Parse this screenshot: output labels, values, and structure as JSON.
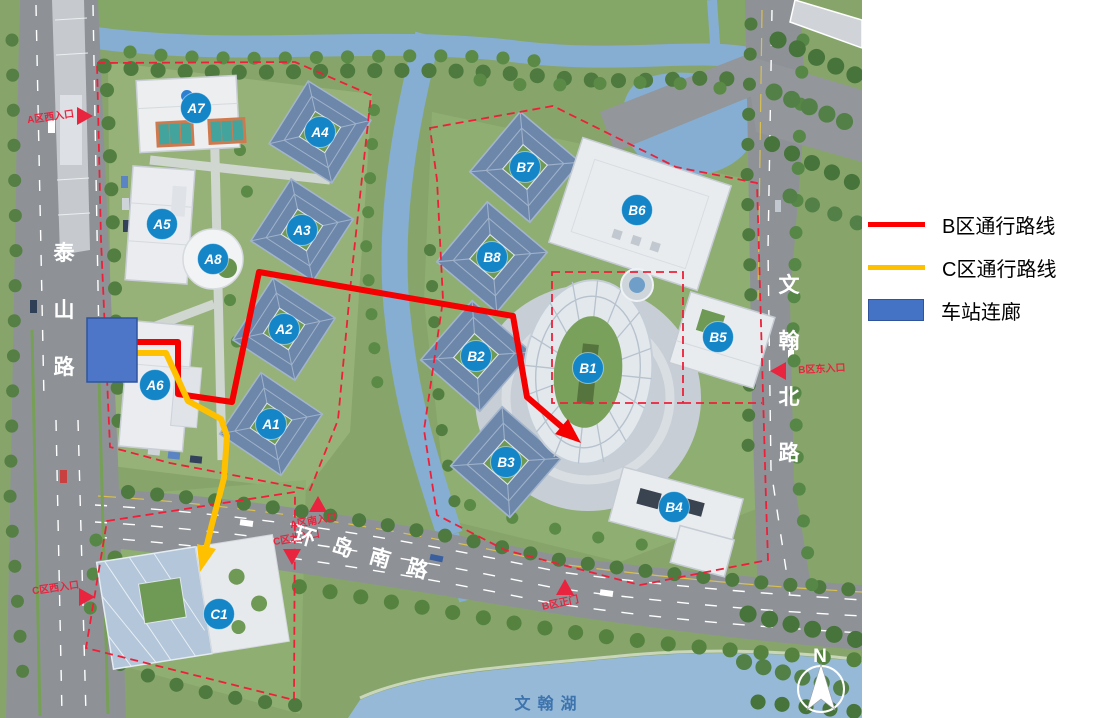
{
  "legend": {
    "items": [
      {
        "label": "B区通行路线",
        "color": "#FF0000",
        "type": "line"
      },
      {
        "label": "C区通行路线",
        "color": "#FFC000",
        "type": "line"
      },
      {
        "label": "车站连廊",
        "color": "#4472C4",
        "type": "rect"
      }
    ]
  },
  "map": {
    "buildings": [
      {
        "label": "A1",
        "x": 271,
        "y": 424
      },
      {
        "label": "A2",
        "x": 284,
        "y": 329
      },
      {
        "label": "A3",
        "x": 302,
        "y": 230
      },
      {
        "label": "A4",
        "x": 320,
        "y": 132
      },
      {
        "label": "A5",
        "x": 162,
        "y": 224
      },
      {
        "label": "A6",
        "x": 155,
        "y": 385
      },
      {
        "label": "A7",
        "x": 196,
        "y": 108
      },
      {
        "label": "A8",
        "x": 213,
        "y": 259
      },
      {
        "label": "B1",
        "x": 588,
        "y": 368
      },
      {
        "label": "B2",
        "x": 476,
        "y": 356
      },
      {
        "label": "B3",
        "x": 506,
        "y": 462
      },
      {
        "label": "B4",
        "x": 674,
        "y": 507
      },
      {
        "label": "B5",
        "x": 718,
        "y": 337
      },
      {
        "label": "B6",
        "x": 637,
        "y": 210
      },
      {
        "label": "B7",
        "x": 525,
        "y": 167
      },
      {
        "label": "B8",
        "x": 492,
        "y": 257
      },
      {
        "label": "C1",
        "x": 219,
        "y": 614
      }
    ],
    "entrances": [
      {
        "label": "A区西入口",
        "x": 51,
        "y": 120,
        "rot": -8,
        "dir": "right",
        "tx": 84,
        "ty": 116
      },
      {
        "label": "A区南入口",
        "x": 314,
        "y": 524,
        "rot": -10,
        "dir": "up",
        "tx": 318,
        "ty": 505
      },
      {
        "label": "C区北入口",
        "x": 297,
        "y": 541,
        "rot": -10,
        "dir": "down",
        "tx": 292,
        "ty": 556
      },
      {
        "label": "C区西入口",
        "x": 56,
        "y": 591,
        "rot": -8,
        "dir": "right",
        "tx": 86,
        "ty": 597
      },
      {
        "label": "B区正门",
        "x": 561,
        "y": 606,
        "rot": -12,
        "dir": "up",
        "tx": 565,
        "ty": 588
      },
      {
        "label": "B区东入口",
        "x": 822,
        "y": 372,
        "rot": -3,
        "dir": "left",
        "tx": 779,
        "ty": 371
      }
    ],
    "roads": {
      "taishan": "泰山路",
      "huandao_south": "环岛南路",
      "wenhan_north": "文翰北路"
    },
    "lake_label": "文翰湖",
    "north_label": "N"
  }
}
